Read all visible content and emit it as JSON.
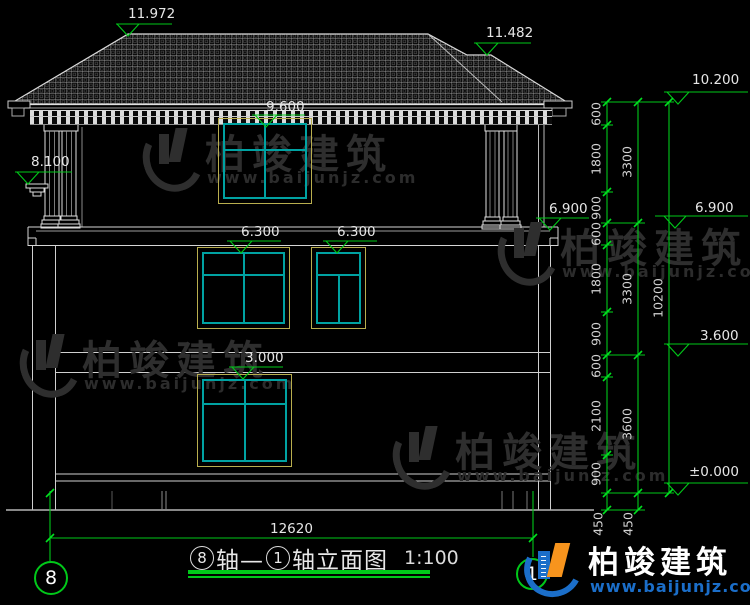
{
  "watermark": {
    "name": "柏竣建筑",
    "url": "www.baijunjz.com"
  },
  "brand": {
    "name": "柏竣建筑",
    "url": "www.baijunjz.com"
  },
  "title": {
    "axis_start": "8",
    "mid": "轴—",
    "axis_end": "1",
    "suffix": "轴立面图",
    "scale": "1:100"
  },
  "axis_bubbles": {
    "left": "8",
    "right": "1"
  },
  "elevations": {
    "ridge_main": "11.972",
    "ridge_upper_right": "11.482",
    "win3_top": "9.600",
    "porch_rail": "8.100",
    "porch_floor_left": "6.900",
    "win2_left_top": "6.300",
    "win2_right_top": "6.300",
    "win1_top": "3.000",
    "right_top": "10.200",
    "right_mid": "6.900",
    "right_low": "3.600",
    "right_zero": "±0.000"
  },
  "dims": {
    "inner": [
      "600",
      "1800",
      "900",
      "600",
      "1800",
      "900",
      "600",
      "2100",
      "900"
    ],
    "mid": [
      "3300",
      "3300",
      "3600"
    ],
    "total_height": "10200",
    "below_grade": [
      "450",
      "450"
    ],
    "total_width": "12620"
  },
  "colors": {
    "background": "#000000",
    "line_white": "#d9d9d9",
    "dim_green": "#00c819",
    "window_teal": "#00a2a2",
    "window_outline": "#b9ae4e",
    "logo_blue": "#1b6ec9",
    "logo_orange": "#f7941d",
    "watermark_gray": "#2e2e2e"
  }
}
